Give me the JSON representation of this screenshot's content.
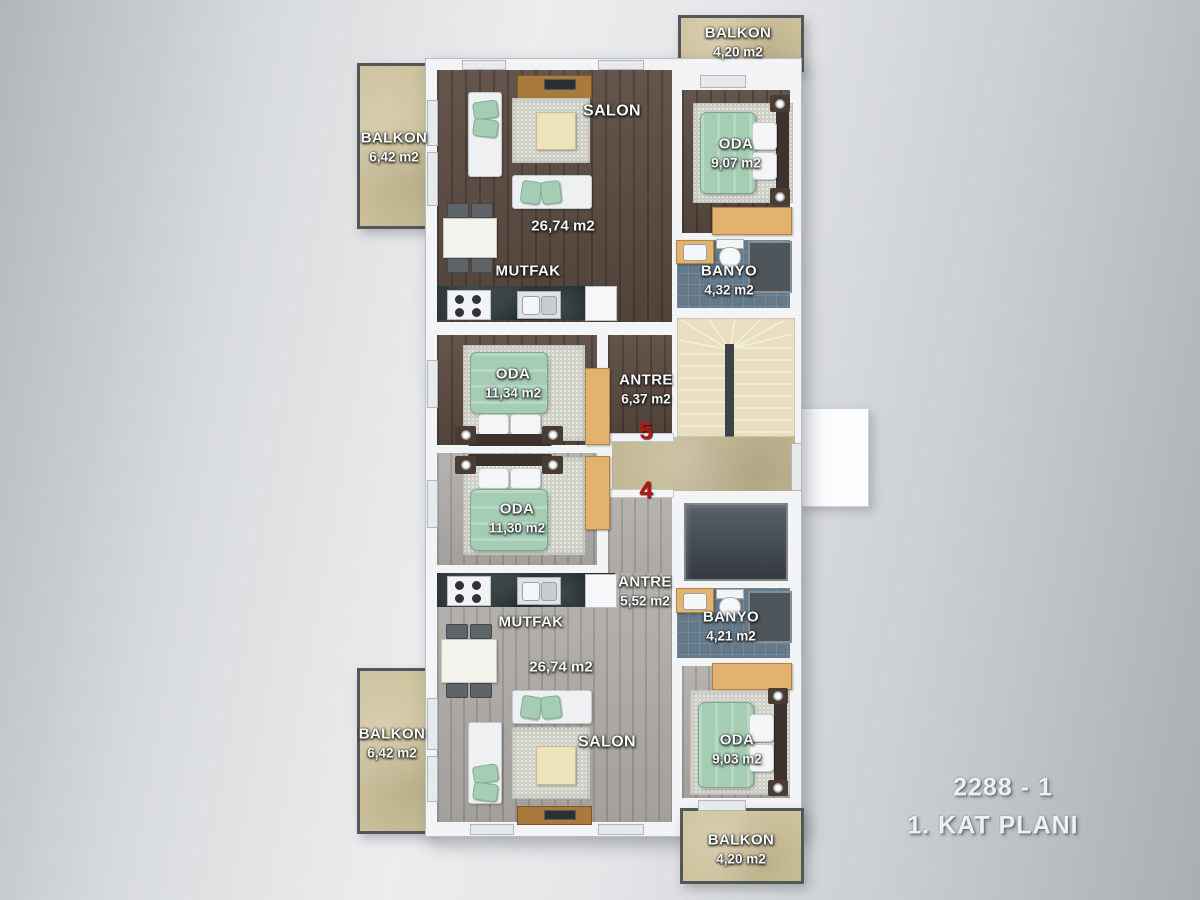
{
  "title": {
    "code": "2288 - 1",
    "floor": "1. KAT PLANI"
  },
  "unit_numbers": {
    "upper": "5",
    "lower": "4"
  },
  "rooms": {
    "balkon_top_left": {
      "name": "BALKON",
      "area": "6,42 m2"
    },
    "balkon_top_right": {
      "name": "BALKON",
      "area": "4,20 m2"
    },
    "salon_upper": {
      "name": "SALON",
      "area": "26,74 m2"
    },
    "mutfak_upper": {
      "name": "MUTFAK"
    },
    "oda_upper_right": {
      "name": "ODA",
      "area": "9,07 m2"
    },
    "banyo_upper": {
      "name": "BANYO",
      "area": "4,32 m2"
    },
    "oda_upper_mid": {
      "name": "ODA",
      "area": "11,34 m2"
    },
    "antre_upper": {
      "name": "ANTRE",
      "area": "6,37 m2"
    },
    "oda_lower_mid": {
      "name": "ODA",
      "area": "11,30 m2"
    },
    "antre_lower": {
      "name": "ANTRE",
      "area": "5,52 m2"
    },
    "banyo_lower": {
      "name": "BANYO",
      "area": "4,21 m2"
    },
    "mutfak_lower": {
      "name": "MUTFAK"
    },
    "salon_lower": {
      "name": "SALON",
      "area": "26,74 m2"
    },
    "oda_lower_right": {
      "name": "ODA",
      "area": "9,03 m2"
    },
    "balkon_bottom_left": {
      "name": "BALKON",
      "area": "6,42 m2"
    },
    "balkon_bottom_right": {
      "name": "BALKON",
      "area": "4,20 m2"
    }
  },
  "palette": {
    "wall_white": "#f2f4f5",
    "floor_dark_wood": "#5a4b41",
    "floor_gray_wood": "#adaaa6",
    "balcony": "#cdc29c",
    "bath_tile": "#64798a",
    "stairs": "#e8dfc1",
    "hall": "#c3b894",
    "elevator": "#3c4248",
    "bed_green": "#a5cdb4",
    "wood_furniture": "#e2b26e",
    "counter_dark": "#20292b",
    "unit_number_red": "#c0130e"
  }
}
